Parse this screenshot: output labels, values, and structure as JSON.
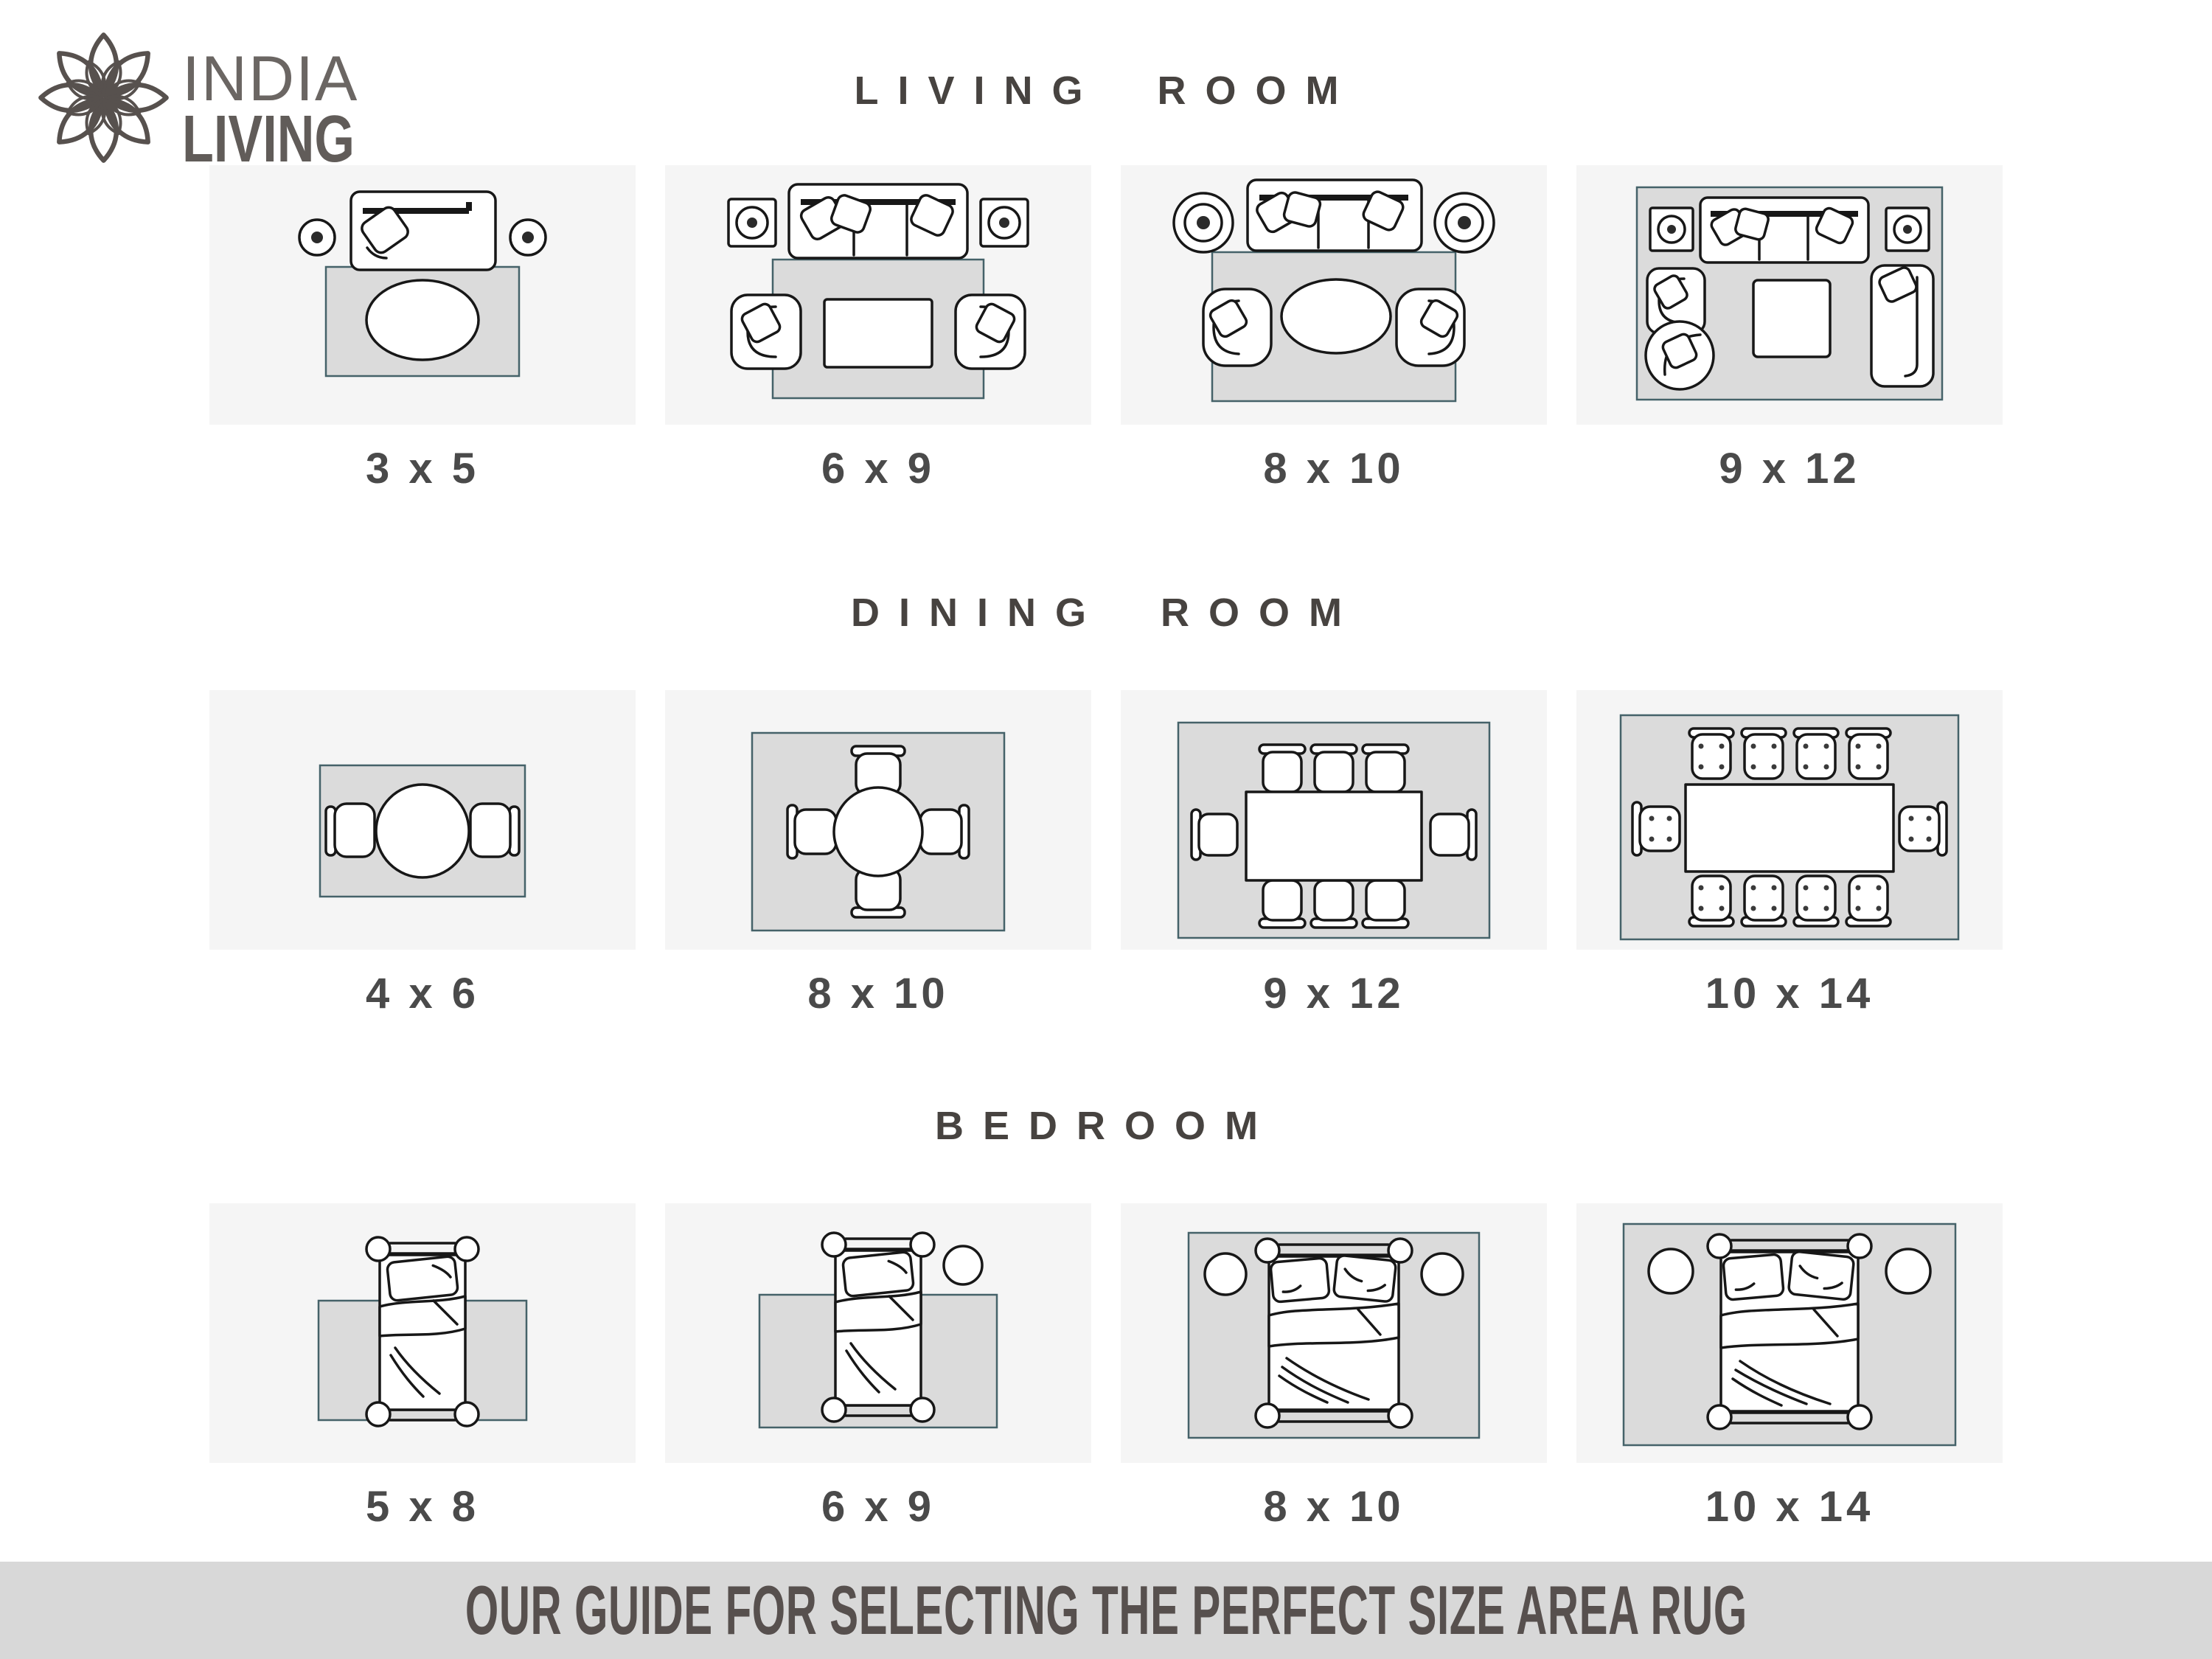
{
  "brand": {
    "name_top": "INDIA",
    "name_bottom": "LIVING"
  },
  "sections": [
    {
      "title": "LIVING ROOM",
      "tiles": [
        {
          "size": "3 x 5"
        },
        {
          "size": "6 x 9"
        },
        {
          "size": "8 x 10"
        },
        {
          "size": "9 x 12"
        }
      ]
    },
    {
      "title": "DINING ROOM",
      "tiles": [
        {
          "size": "4 x 6"
        },
        {
          "size": "8 x 10"
        },
        {
          "size": "9 x 12"
        },
        {
          "size": "10 x 14"
        }
      ]
    },
    {
      "title": "BEDROOM",
      "tiles": [
        {
          "size": "5 x 8"
        },
        {
          "size": "6 x 9"
        },
        {
          "size": "8 x 10"
        },
        {
          "size": "10 x 14"
        }
      ]
    }
  ],
  "footer": {
    "text": "OUR GUIDE FOR SELECTING THE PERFECT SIZE AREA RUG"
  },
  "colors": {
    "panel_bg": "#f5f5f5",
    "rug_fill": "#dbdbdb",
    "rug_border": "#456269",
    "banner_bg": "#d8d8d8",
    "heading_text": "#474340",
    "label_text": "#4a4a4a",
    "brand_text": "#615c59"
  }
}
